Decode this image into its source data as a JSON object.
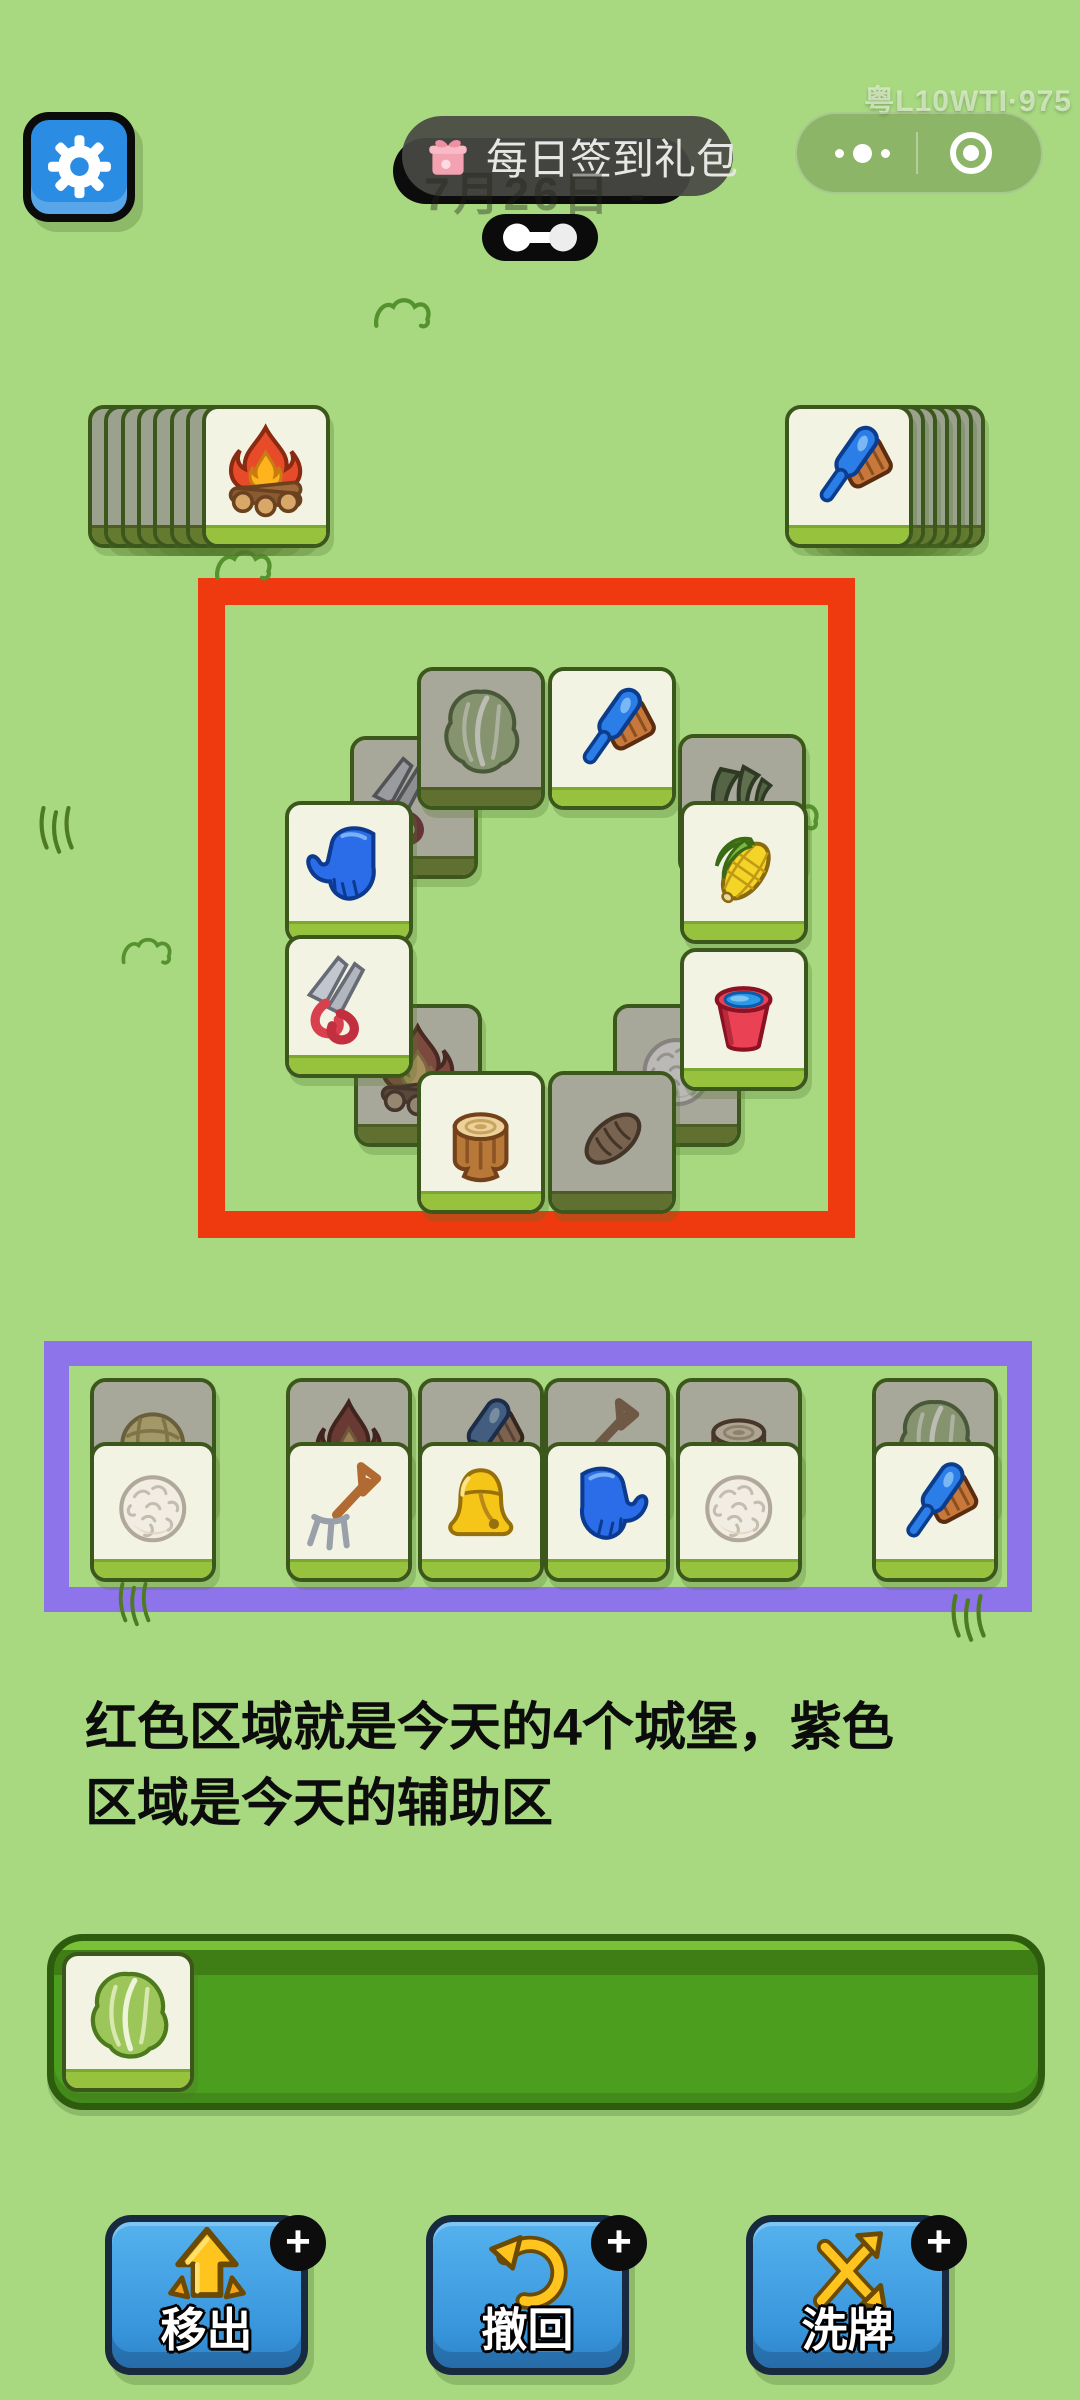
{
  "watermark": {
    "text": "粤L10WTI·975"
  },
  "header": {
    "settings_button": {
      "icon": "gear"
    },
    "signin_pill": {
      "icon": "gift",
      "label": "每日签到礼包"
    },
    "date_ghost": {
      "text": "7月26日 -"
    },
    "handle_toggle": {
      "icon": "dumbbell"
    },
    "capsule": {
      "more_icon": "ellipsis-dots",
      "target_icon": "record-circle"
    }
  },
  "board": {
    "left_stack": {
      "front_icon": "campfire",
      "back_count": 7,
      "x": 202,
      "y": 405
    },
    "right_stack": {
      "front_icon": "brush",
      "back_count": 6,
      "x": 785,
      "y": 405
    },
    "castle_zone": {
      "outline_color": "#ee3a0e",
      "tiles": [
        {
          "icon": "shears",
          "shade": "dark",
          "x": 350,
          "y": 736
        },
        {
          "icon": "corn-leaves",
          "shade": "dark",
          "x": 678,
          "y": 734
        },
        {
          "icon": "cabbage",
          "shade": "dark",
          "x": 417,
          "y": 667
        },
        {
          "icon": "campfire",
          "shade": "dark",
          "x": 354,
          "y": 1004
        },
        {
          "icon": "wool",
          "shade": "dark",
          "x": 613,
          "y": 1004
        },
        {
          "icon": "bread",
          "shade": "dark",
          "x": 548,
          "y": 1071
        },
        {
          "icon": "brush",
          "shade": "bright",
          "x": 548,
          "y": 667
        },
        {
          "icon": "glove",
          "shade": "bright",
          "x": 285,
          "y": 801,
          "flip": true
        },
        {
          "icon": "corn",
          "shade": "bright",
          "x": 680,
          "y": 801
        },
        {
          "icon": "shears",
          "shade": "bright",
          "x": 285,
          "y": 935
        },
        {
          "icon": "bucket",
          "shade": "bright",
          "x": 680,
          "y": 948
        },
        {
          "icon": "stump",
          "shade": "bright",
          "x": 417,
          "y": 1071
        }
      ]
    },
    "helper_zone": {
      "outline_color": "#8d74ea",
      "front_y": 1442,
      "back_y": 1378,
      "stacks": [
        {
          "x": 90,
          "back": "yarn",
          "front": "wool"
        },
        {
          "x": 286,
          "back": "fire",
          "front": "pitchfork"
        },
        {
          "x": 418,
          "back": "brush",
          "front": "bell"
        },
        {
          "x": 544,
          "back": "shovel",
          "front": "glove"
        },
        {
          "x": 676,
          "back": "stump",
          "front": "wool"
        },
        {
          "x": 872,
          "back": "cabbage",
          "front": "brush"
        }
      ]
    }
  },
  "caption": {
    "line1": "红色区域就是今天的4个城堡，紫色",
    "line2": "区域是今天的辅助区"
  },
  "slot_bar": {
    "tiles": [
      {
        "icon": "cabbage"
      }
    ]
  },
  "actions": [
    {
      "id": "move-out",
      "label": "移出",
      "icon": "arrow-up-icon",
      "badge": "+",
      "x": 105
    },
    {
      "id": "undo",
      "label": "撤回",
      "icon": "undo-arrow-icon",
      "badge": "+",
      "x": 426
    },
    {
      "id": "shuffle",
      "label": "洗牌",
      "icon": "shuffle-icon",
      "badge": "+",
      "x": 746
    }
  ],
  "decorations": [
    {
      "type": "bush",
      "x": 372,
      "y": 296,
      "w": 64,
      "h": 34
    },
    {
      "type": "bush",
      "x": 214,
      "y": 548,
      "w": 62,
      "h": 34
    },
    {
      "type": "bush",
      "x": 120,
      "y": 936,
      "w": 56,
      "h": 30
    },
    {
      "type": "bush",
      "x": 762,
      "y": 798,
      "w": 60,
      "h": 34
    },
    {
      "type": "grass",
      "x": 36,
      "y": 806,
      "w": 40,
      "h": 52
    },
    {
      "type": "grass",
      "x": 116,
      "y": 1582,
      "w": 36,
      "h": 48
    },
    {
      "type": "grass",
      "x": 948,
      "y": 1594,
      "w": 40,
      "h": 52
    }
  ],
  "colors": {
    "background": "#a8d981",
    "castle_outline": "#ee3a0e",
    "helper_outline": "#8d74ea",
    "tile_face": "#f2f3e3",
    "tile_face_dark": "#a8a89a",
    "button_blue": "#3a97dd"
  }
}
